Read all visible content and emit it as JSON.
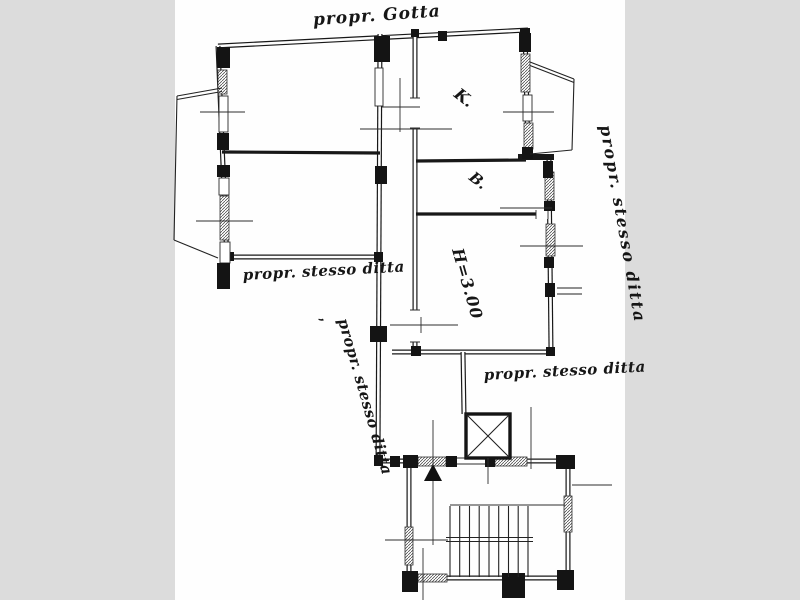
{
  "colors": {
    "background": "#dcdcdc",
    "paper": "#ffffff",
    "ink": "#181818"
  },
  "annotations": {
    "top_owner": "propr. Gotta",
    "left_owner": "propr. stesso ditta",
    "diagonal_owner": "propr. stesso ditta",
    "diagonal_tick": ",",
    "right_owner": "propr. stesso ditta",
    "middle_owner": "propr. stesso ditta"
  },
  "rooms": {
    "kitchen": "K.",
    "bath": "B.",
    "height": "H=3.00"
  }
}
